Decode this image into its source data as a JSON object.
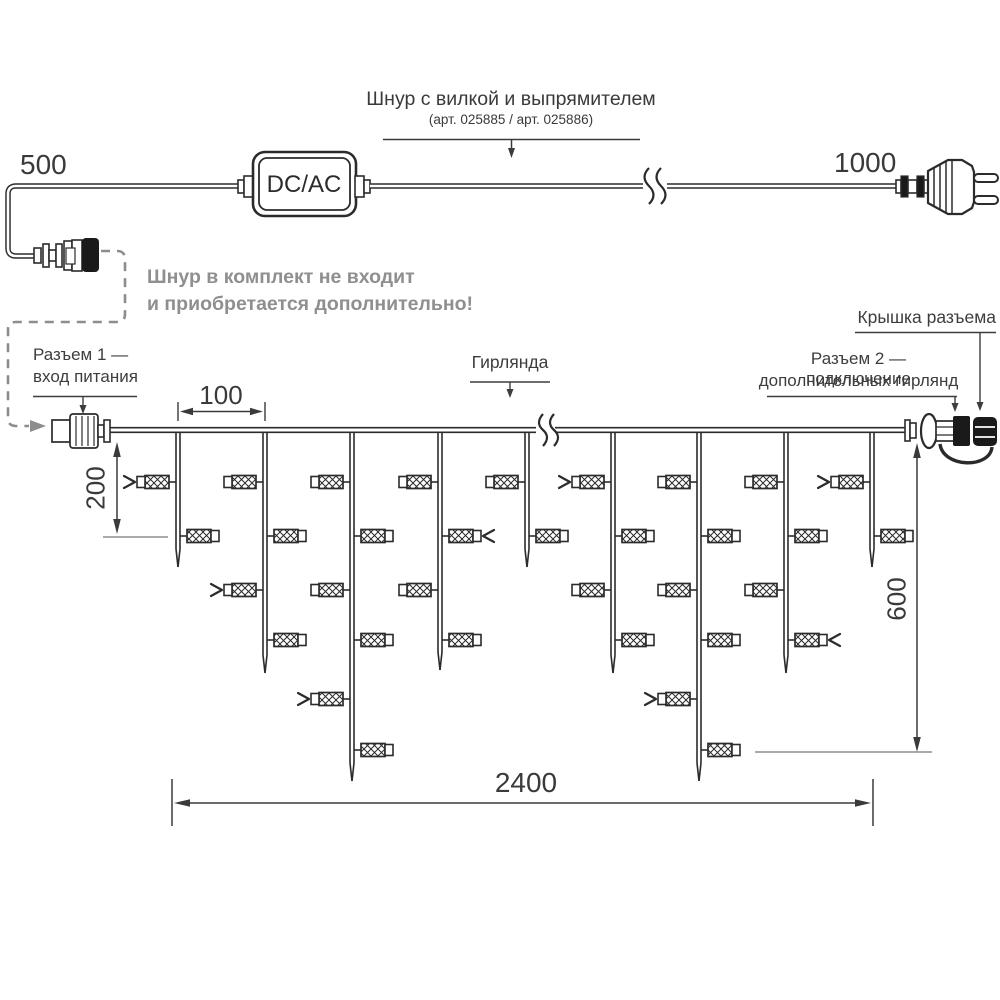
{
  "labels": {
    "cord_title": "Шнур с вилкой и выпрямителем",
    "cord_subtitle": "(арт. 025885 / арт. 025886)",
    "len_left": "500",
    "len_right": "1000",
    "converter": "DC/AC",
    "note1": "Шнур в комплект не входит",
    "note2": "и приобретается дополнительно!",
    "connector1_l1": "Разъем 1 —",
    "connector1_l2": "вход питания",
    "garland": "Гирлянда",
    "connector2_l1": "Разъем 2 — подключение",
    "connector2_l2": "дополнительных гирлянд",
    "cap": "Крышка разъема",
    "dim_spacing": "100",
    "dim_short": "200",
    "dim_long": "600",
    "dim_total": "2400"
  },
  "garland_structure": {
    "wire_y": 430,
    "wire_x_start": 109,
    "wire_x_end": 905,
    "lamp_level_y": [
      482,
      536,
      590,
      640,
      699,
      750
    ],
    "drops": [
      {
        "x": 178,
        "tip_y": 567,
        "lamps": 2
      },
      {
        "x": 265,
        "tip_y": 673,
        "lamps": 4
      },
      {
        "x": 352,
        "tip_y": 781,
        "lamps": 6
      },
      {
        "x": 440,
        "tip_y": 670,
        "lamps": 4
      },
      {
        "x": 527,
        "tip_y": 567,
        "lamps": 2
      },
      {
        "x": 613,
        "tip_y": 673,
        "lamps": 4
      },
      {
        "x": 699,
        "tip_y": 781,
        "lamps": 6
      },
      {
        "x": 786,
        "tip_y": 673,
        "lamps": 4
      },
      {
        "x": 872,
        "tip_y": 567,
        "lamps": 2
      }
    ],
    "marked_lamps": [
      {
        "drop": 0,
        "level": 1
      },
      {
        "drop": 1,
        "level": 3
      },
      {
        "drop": 2,
        "level": 5
      },
      {
        "drop": 3,
        "level": 2
      },
      {
        "drop": 5,
        "level": 1
      },
      {
        "drop": 6,
        "level": 5
      },
      {
        "drop": 7,
        "level": 4
      },
      {
        "drop": 8,
        "level": 1
      }
    ]
  },
  "colors": {
    "line": "#2b2b2b",
    "fill_black": "#1a1a1a",
    "gray": "#8d8d8d",
    "text": "#3d3d3d"
  }
}
